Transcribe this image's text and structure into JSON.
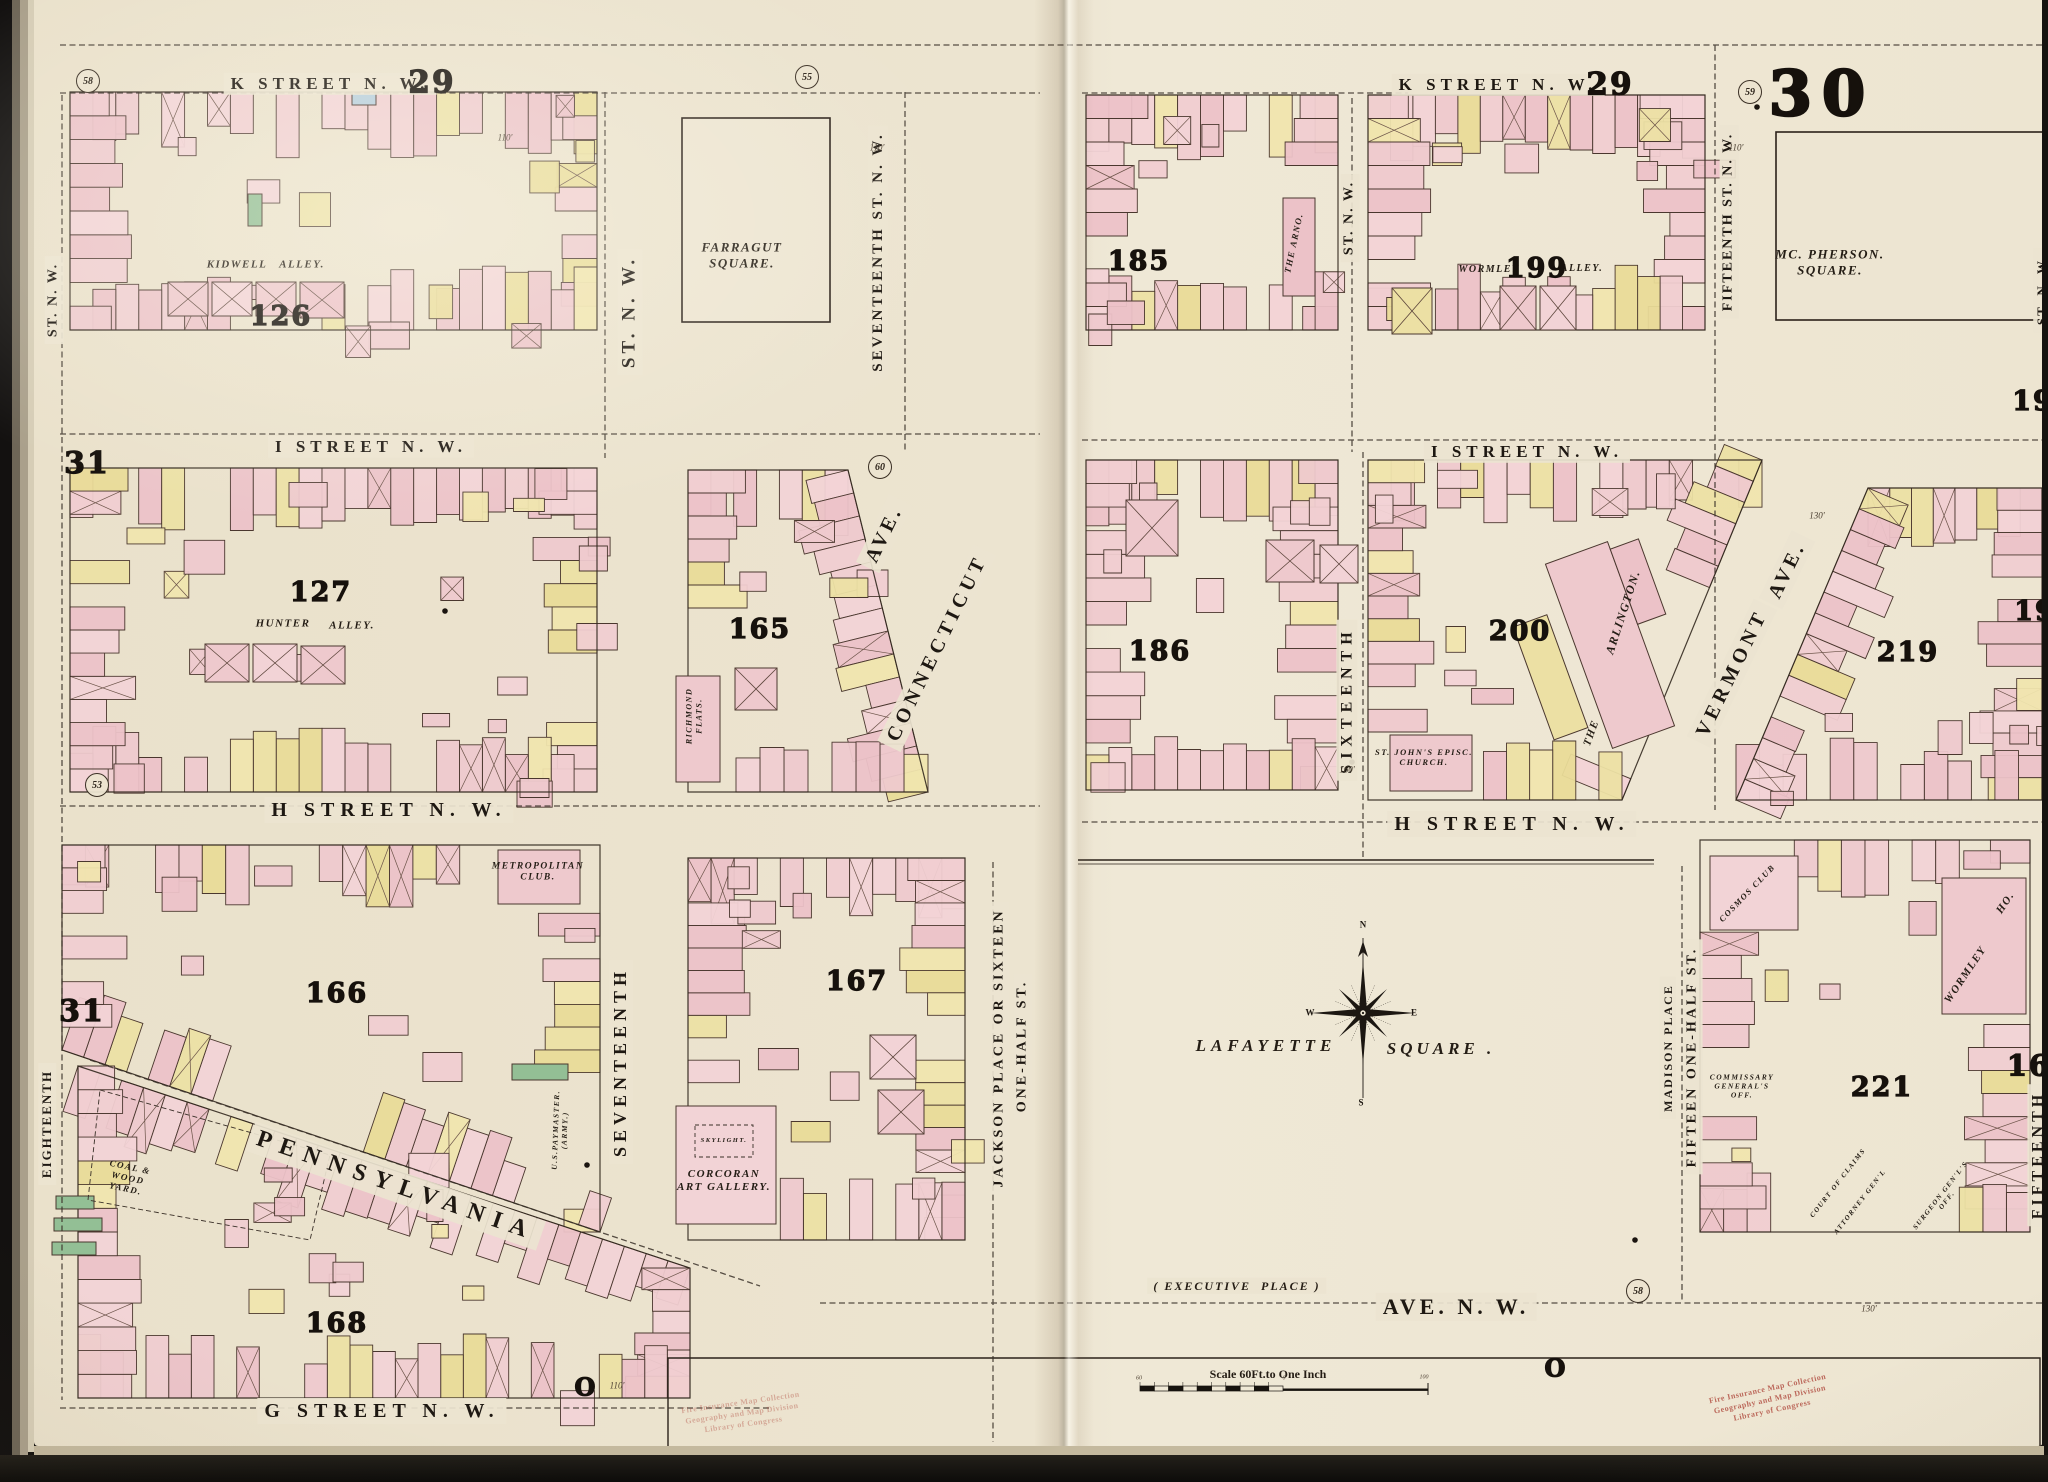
{
  "page_numbers": [
    {
      "id": "sheet-30",
      "text": "30",
      "x": 1822,
      "y": 94,
      "size": 62
    },
    {
      "id": "k29-left",
      "text": "29",
      "x": 432,
      "y": 83,
      "size": 31
    },
    {
      "id": "k29-right",
      "text": "29",
      "x": 1610,
      "y": 85,
      "size": 31
    },
    {
      "id": "n31-top",
      "text": "31",
      "x": 87,
      "y": 464,
      "size": 30
    },
    {
      "id": "n31-bottom",
      "text": "31",
      "x": 82,
      "y": 1012,
      "size": 30
    },
    {
      "id": "n19-top",
      "text": "19",
      "x": 2033,
      "y": 402,
      "size": 27
    },
    {
      "id": "n19-mid",
      "text": "19",
      "x": 2035,
      "y": 612,
      "size": 27
    },
    {
      "id": "n16",
      "text": "16",
      "x": 2029,
      "y": 1066,
      "size": 29
    }
  ],
  "block_numbers": [
    {
      "id": "126",
      "text": "126",
      "x": 281,
      "y": 317
    },
    {
      "id": "127",
      "text": "127",
      "x": 321,
      "y": 593
    },
    {
      "id": "165",
      "text": "165",
      "x": 760,
      "y": 630
    },
    {
      "id": "166",
      "text": "166",
      "x": 337,
      "y": 994
    },
    {
      "id": "167",
      "text": "167",
      "x": 857,
      "y": 982
    },
    {
      "id": "168",
      "text": "168",
      "x": 337,
      "y": 1324
    },
    {
      "id": "185",
      "text": "185",
      "x": 1139,
      "y": 262
    },
    {
      "id": "186",
      "text": "186",
      "x": 1160,
      "y": 652
    },
    {
      "id": "199",
      "text": "199",
      "x": 1537,
      "y": 269
    },
    {
      "id": "200",
      "text": "200",
      "x": 1520,
      "y": 632
    },
    {
      "id": "219",
      "text": "219",
      "x": 1908,
      "y": 653
    },
    {
      "id": "221",
      "text": "221",
      "x": 1882,
      "y": 1088
    }
  ],
  "streets": [
    {
      "id": "k-street-left",
      "text": "K STREET N. W.",
      "x": 330,
      "y": 84,
      "rot": 0,
      "size": 17,
      "ls": 5
    },
    {
      "id": "k-street-right",
      "text": "K STREET N. W.",
      "x": 1498,
      "y": 85,
      "rot": 0,
      "size": 17,
      "ls": 5
    },
    {
      "id": "i-street-left",
      "text": "I STREET N. W.",
      "x": 371,
      "y": 447,
      "rot": 0,
      "size": 17,
      "ls": 5
    },
    {
      "id": "i-street-right",
      "text": "I STREET N. W.",
      "x": 1527,
      "y": 452,
      "rot": 0,
      "size": 17,
      "ls": 5
    },
    {
      "id": "h-street-left",
      "text": "H STREET N. W.",
      "x": 389,
      "y": 810,
      "rot": 0,
      "size": 20,
      "ls": 6
    },
    {
      "id": "h-street-right",
      "text": "H STREET N. W.",
      "x": 1512,
      "y": 824,
      "rot": 0,
      "size": 20,
      "ls": 6
    },
    {
      "id": "g-street",
      "text": "G STREET N. W.",
      "x": 382,
      "y": 1411,
      "rot": 0,
      "size": 20,
      "ls": 6
    },
    {
      "id": "pennsylvania",
      "text": "PENNSYLVANIA",
      "x": 396,
      "y": 1186,
      "rot": 19,
      "size": 24,
      "ls": 9
    },
    {
      "id": "ave-nw",
      "text": "AVE. N. W.",
      "x": 1456,
      "y": 1307,
      "rot": 0,
      "size": 22,
      "ls": 4
    },
    {
      "id": "executive-place",
      "text": "( EXECUTIVE  PLACE )",
      "x": 1237,
      "y": 1286,
      "rot": 0,
      "size": 12,
      "ls": 2,
      "cls": "it"
    },
    {
      "id": "st-nw-18th-top",
      "text": "ST. N. W.",
      "x": 54,
      "y": 300,
      "rot": -90,
      "size": 14,
      "ls": 2
    },
    {
      "id": "st-nw-17th-west",
      "text": "ST. N. W.",
      "x": 630,
      "y": 312,
      "rot": -90,
      "size": 19,
      "ls": 4
    },
    {
      "id": "seventeenth-st-nw",
      "text": "SEVENTEENTH ST. N. W.",
      "x": 878,
      "y": 252,
      "rot": -90,
      "size": 15,
      "ls": 3
    },
    {
      "id": "st-nw-16th-top",
      "text": "ST. N. W.",
      "x": 1350,
      "y": 218,
      "rot": -90,
      "size": 14,
      "ls": 2
    },
    {
      "id": "fifteenth-st-nw",
      "text": "FIFTEENTH ST. N. W.",
      "x": 1729,
      "y": 222,
      "rot": -90,
      "size": 14,
      "ls": 2
    },
    {
      "id": "st-nw-right-edge",
      "text": "ST. N. W.",
      "x": 2042,
      "y": 290,
      "rot": -90,
      "size": 13,
      "ls": 2
    },
    {
      "id": "sixteenth",
      "text": "SIXTEENTH",
      "x": 1347,
      "y": 700,
      "rot": -90,
      "size": 16,
      "ls": 6
    },
    {
      "id": "seventeenth",
      "text": "SEVENTEENTH",
      "x": 621,
      "y": 1062,
      "rot": -90,
      "size": 18,
      "ls": 5
    },
    {
      "id": "jackson-place",
      "text": "JACKSON PLACE OR SIXTEEN",
      "x": 1000,
      "y": 1048,
      "rot": -90,
      "size": 14,
      "ls": 3
    },
    {
      "id": "one-half-st",
      "text": "ONE-HALF ST.",
      "x": 1023,
      "y": 1046,
      "rot": -90,
      "size": 14,
      "ls": 3
    },
    {
      "id": "madison-place",
      "text": "MADISON PLACE",
      "x": 1668,
      "y": 1048,
      "rot": -90,
      "size": 12,
      "ls": 2
    },
    {
      "id": "fifteen-one-half-st",
      "text": "FIFTEEN ONE-HALF ST.",
      "x": 1693,
      "y": 1057,
      "rot": -90,
      "size": 14,
      "ls": 3
    },
    {
      "id": "eighteenth",
      "text": "EIGHTEENTH",
      "x": 47,
      "y": 1124,
      "rot": -90,
      "size": 13,
      "ls": 2
    },
    {
      "id": "fifteenth-bottom",
      "text": "FIFTEENTH",
      "x": 2038,
      "y": 1155,
      "rot": -90,
      "size": 16,
      "ls": 4
    },
    {
      "id": "connecticut",
      "text": "CONNECTICUT",
      "x": 937,
      "y": 648,
      "rot": -64,
      "size": 20,
      "ls": 5
    },
    {
      "id": "connecticut-ave",
      "text": "AVE.",
      "x": 884,
      "y": 534,
      "rot": -64,
      "size": 20,
      "ls": 4
    },
    {
      "id": "vermont",
      "text": "VERMONT",
      "x": 1732,
      "y": 673,
      "rot": -64,
      "size": 20,
      "ls": 5
    },
    {
      "id": "vermont-ave",
      "text": "AVE.",
      "x": 1787,
      "y": 570,
      "rot": -64,
      "size": 20,
      "ls": 4
    }
  ],
  "landmarks": [
    {
      "id": "farragut-square",
      "text": "FARRAGUT\nSQUARE.",
      "x": 742,
      "y": 255,
      "rot": 0,
      "size": 13
    },
    {
      "id": "mcpherson-square",
      "text": "MC. PHERSON.\nSQUARE.",
      "x": 1830,
      "y": 262,
      "rot": 0,
      "size": 13
    },
    {
      "id": "lafayette",
      "text": "LAFAYETTE",
      "x": 1266,
      "y": 1046,
      "rot": 0,
      "size": 17,
      "ls": 5
    },
    {
      "id": "lafayette-square",
      "text": "SQUARE .",
      "x": 1441,
      "y": 1049,
      "rot": 0,
      "size": 17,
      "ls": 4
    },
    {
      "id": "kidwell",
      "text": "KIDWELL",
      "x": 237,
      "y": 265,
      "rot": 0,
      "size": 11
    },
    {
      "id": "kidwell-alley",
      "text": "ALLEY.",
      "x": 302,
      "y": 265,
      "rot": 0,
      "size": 11
    },
    {
      "id": "hunter",
      "text": "HUNTER",
      "x": 283,
      "y": 624,
      "rot": 0,
      "size": 11
    },
    {
      "id": "hunter-alley",
      "text": "ALLEY.",
      "x": 352,
      "y": 626,
      "rot": 0,
      "size": 11
    },
    {
      "id": "wormley",
      "text": "WORMLEY",
      "x": 1489,
      "y": 270,
      "rot": 0,
      "size": 10
    },
    {
      "id": "wormley-alley",
      "text": "ALLEY.",
      "x": 1582,
      "y": 269,
      "rot": 0,
      "size": 10
    },
    {
      "id": "metropolitan-club",
      "text": "METROPOLITAN\nCLUB.",
      "x": 538,
      "y": 873,
      "rot": 0,
      "size": 9.5
    },
    {
      "id": "richmond-flats",
      "text": "RICHMOND\nFLATS.",
      "x": 694,
      "y": 716,
      "rot": -90,
      "size": 8
    },
    {
      "id": "corcoran-art-gallery",
      "text": "CORCORAN\nART GALLERY.",
      "x": 724,
      "y": 1181,
      "rot": 0,
      "size": 11
    },
    {
      "id": "skylight",
      "text": "SKYLIGHT.",
      "x": 724,
      "y": 1141,
      "rot": 0,
      "size": 6.5
    },
    {
      "id": "st-johns-church",
      "text": "ST. JOHN'S EPISC.\nCHURCH.",
      "x": 1424,
      "y": 757,
      "rot": 0,
      "size": 8.5
    },
    {
      "id": "the",
      "text": "THE",
      "x": 1592,
      "y": 733,
      "rot": -70,
      "size": 11
    },
    {
      "id": "arlington",
      "text": "ARLINGTON.",
      "x": 1623,
      "y": 612,
      "rot": -72,
      "size": 12
    },
    {
      "id": "the-arno",
      "text": "THE ARNO.",
      "x": 1294,
      "y": 243,
      "rot": -78,
      "size": 9
    },
    {
      "id": "wormley-ho-1",
      "text": "WORMLEY",
      "x": 1966,
      "y": 975,
      "rot": -56,
      "size": 11
    },
    {
      "id": "wormley-ho-2",
      "text": "HO.",
      "x": 2006,
      "y": 903,
      "rot": -56,
      "size": 11
    },
    {
      "id": "cosmos-club",
      "text": "COSMOS CLUB",
      "x": 1747,
      "y": 893,
      "rot": -46,
      "size": 8.5
    },
    {
      "id": "coal-wood-yard",
      "text": "COAL &\nWOOD\nYARD.",
      "x": 128,
      "y": 1178,
      "rot": 12,
      "size": 9
    },
    {
      "id": "us-paymaster",
      "text": "U.S.PAYMASTER.\n(ARMY.)",
      "x": 560,
      "y": 1130,
      "rot": -88,
      "size": 7.5
    },
    {
      "id": "commissary",
      "text": "COMMISSARY\nGENERAL'S\nOFF.",
      "x": 1742,
      "y": 1086,
      "rot": 0,
      "size": 7.5
    },
    {
      "id": "court-of-claims",
      "text": "COURT OF CLAIMS",
      "x": 1838,
      "y": 1183,
      "rot": -52,
      "size": 7
    },
    {
      "id": "attorney-genl",
      "text": "ATTORNEY GEN'L",
      "x": 1860,
      "y": 1202,
      "rot": -52,
      "size": 7
    },
    {
      "id": "surgeon-genl",
      "text": "SURGEON GEN'L'S OFF.",
      "x": 1944,
      "y": 1198,
      "rot": -52,
      "size": 7
    }
  ],
  "circled_numbers": [
    {
      "text": "58",
      "x": 88,
      "y": 81
    },
    {
      "text": "55",
      "x": 807,
      "y": 77
    },
    {
      "text": "59",
      "x": 1750,
      "y": 92
    },
    {
      "text": "60",
      "x": 880,
      "y": 467
    },
    {
      "text": "53",
      "x": 97,
      "y": 785
    },
    {
      "text": "58",
      "x": 1638,
      "y": 1291
    }
  ],
  "dimensions": [
    {
      "text": "110'",
      "x": 505,
      "y": 138
    },
    {
      "text": "110'",
      "x": 877,
      "y": 148
    },
    {
      "text": "110'",
      "x": 1736,
      "y": 148
    },
    {
      "text": "160'",
      "x": 1347,
      "y": 770
    },
    {
      "text": "130'",
      "x": 1817,
      "y": 516
    },
    {
      "text": "110'",
      "x": 617,
      "y": 1386
    },
    {
      "text": "130'",
      "x": 1869,
      "y": 1309
    }
  ],
  "misc": [
    {
      "id": "big-o-left",
      "text": "O",
      "x": 586,
      "y": 1388,
      "size": 24
    },
    {
      "id": "big-o-right",
      "text": "O",
      "x": 1556,
      "y": 1369,
      "size": 24
    }
  ],
  "compass": {
    "n": "N",
    "e": "E",
    "s": "S",
    "w": "W"
  },
  "scale": {
    "label": "Scale 60Ft.to One Inch",
    "tick_left": "60",
    "tick_zero": "0",
    "tick_right": "100"
  },
  "stamps": [
    {
      "id": "stamp-left",
      "lines": "Fire Insurance Map Collection\nGeography and Map Division\nLibrary of Congress",
      "x": 742,
      "y": 1414,
      "rot": -8,
      "opacity": 0.38,
      "size": 8
    },
    {
      "id": "stamp-right",
      "lines": "Fire Insurance Map Collection\nGeography and Map Division\nLibrary of Congress",
      "x": 1770,
      "y": 1400,
      "rot": -12,
      "opacity": 0.8,
      "size": 8
    }
  ]
}
